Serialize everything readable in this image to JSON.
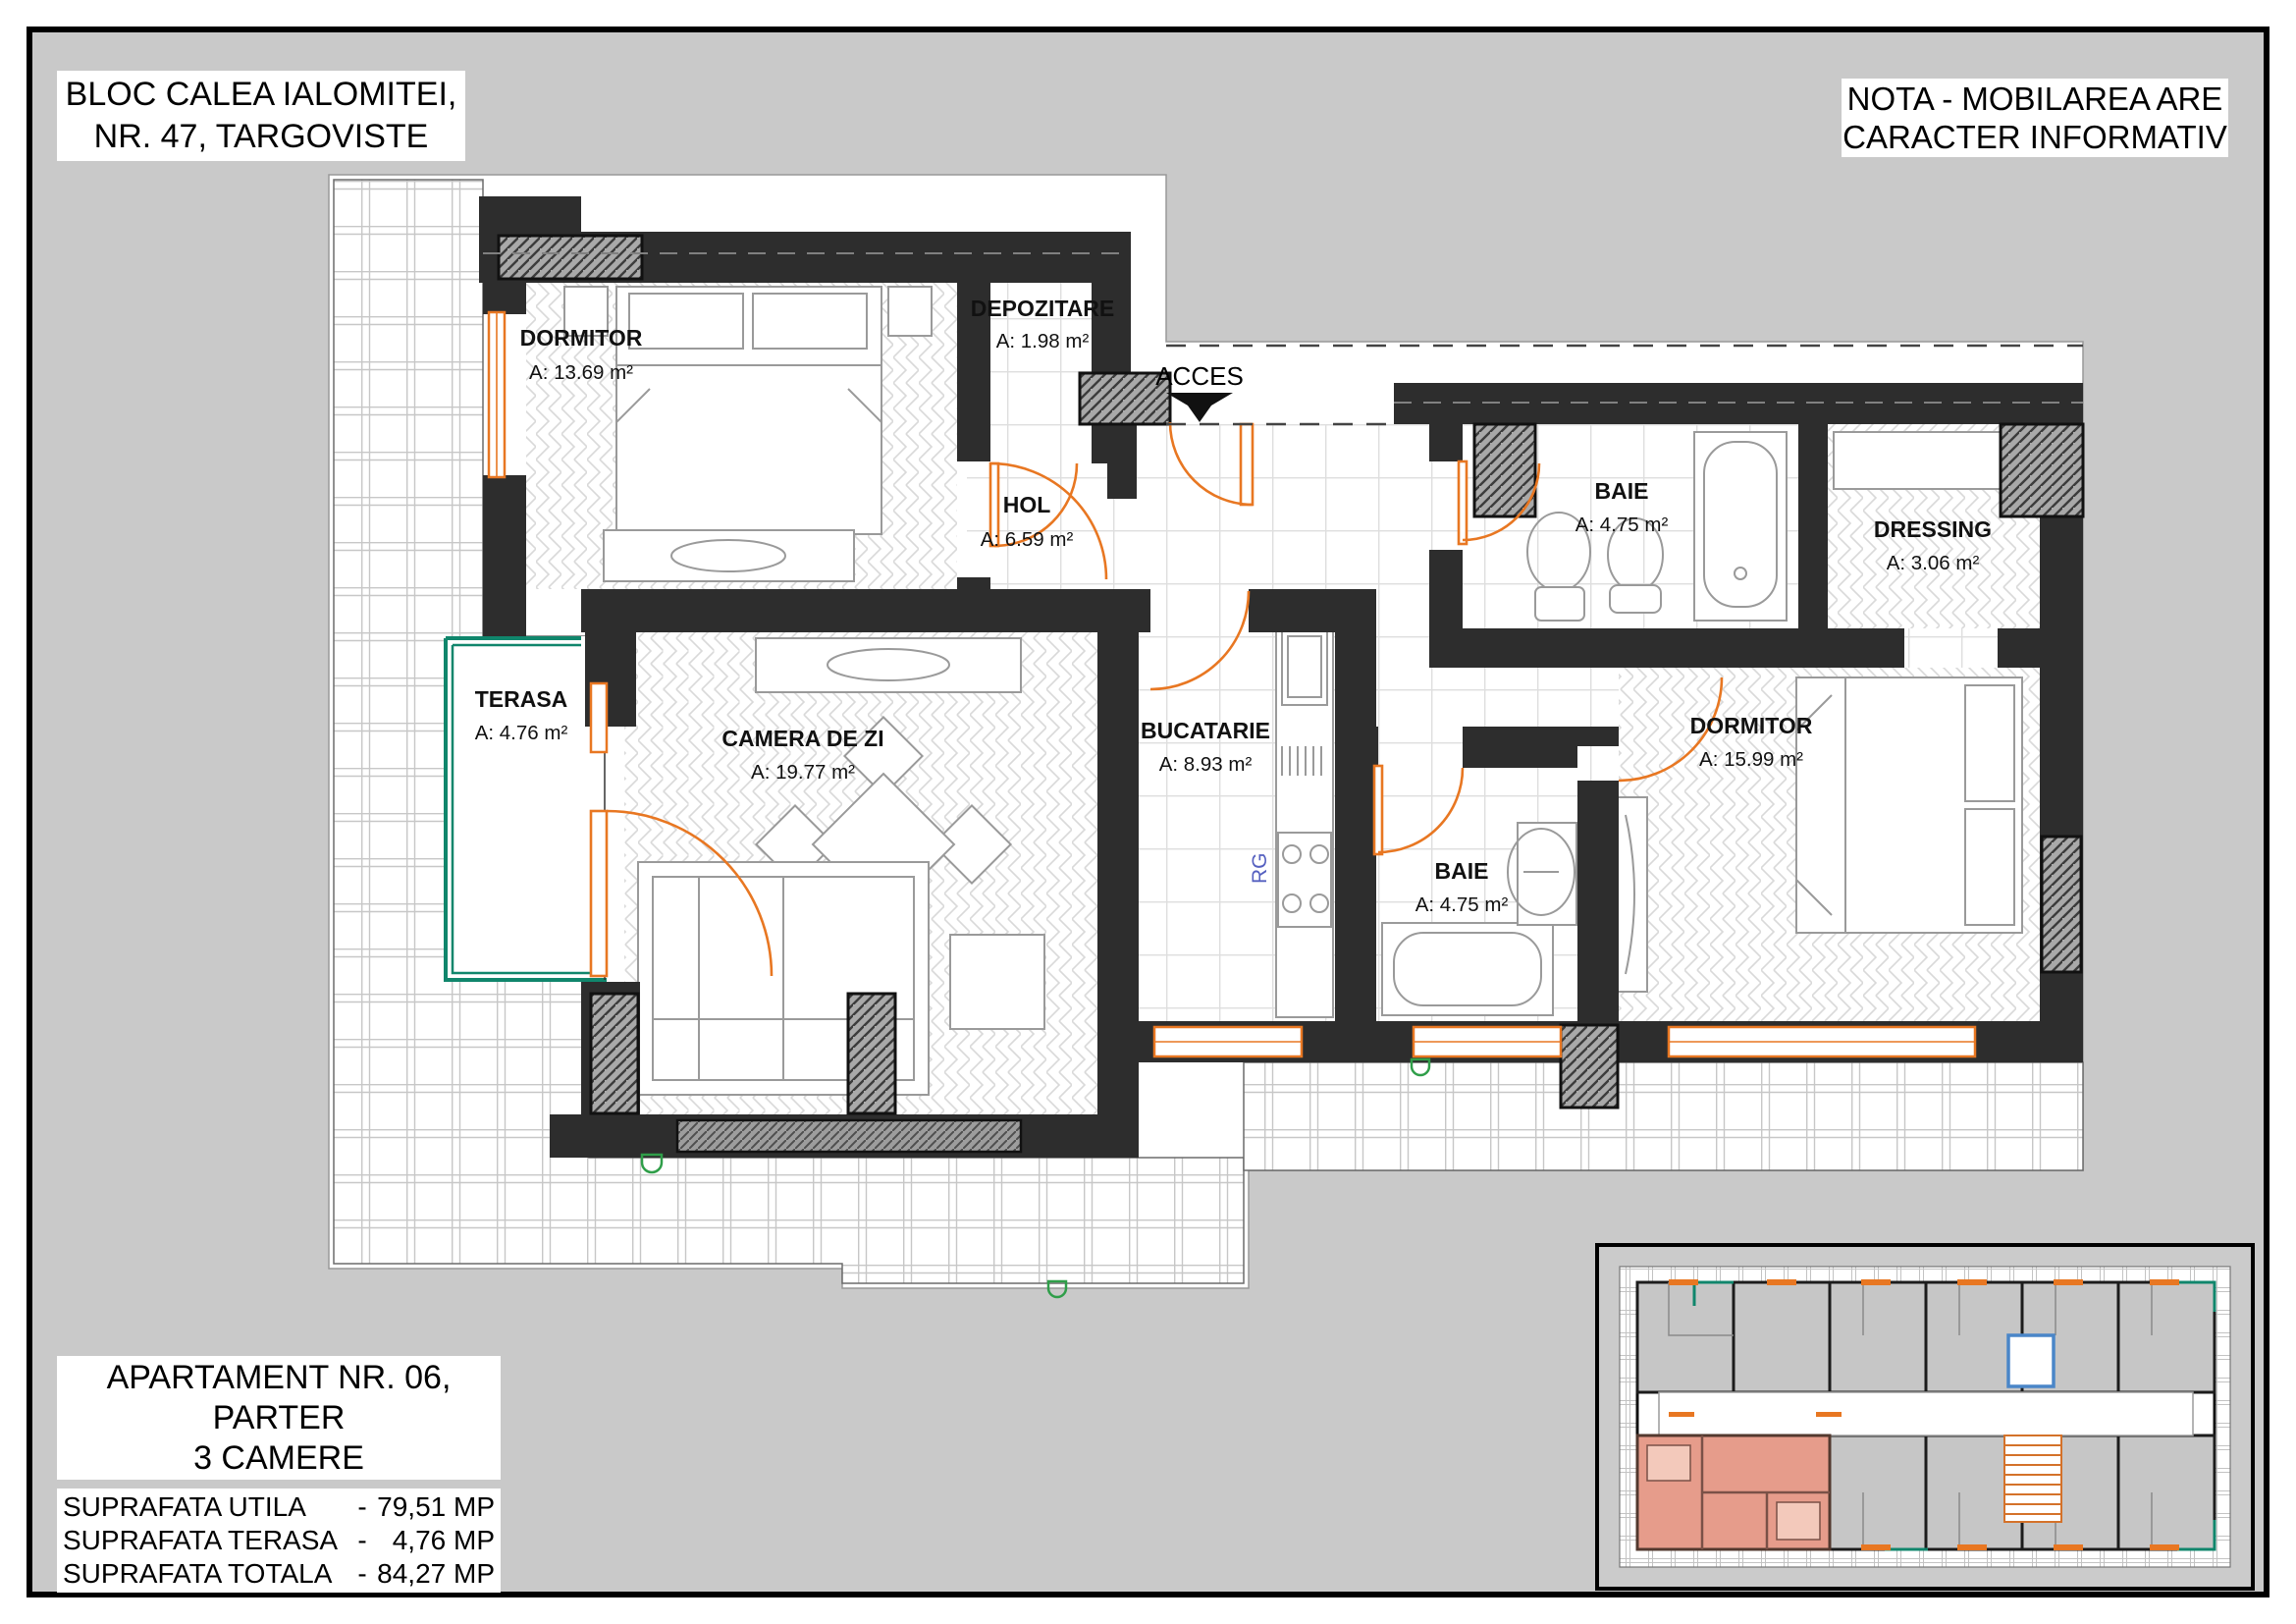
{
  "header": {
    "title_line1": "BLOC CALEA IALOMITEI,",
    "title_line2": "NR. 47, TARGOVISTE",
    "note_line1": "NOTA - MOBILAREA ARE",
    "note_line2": "CARACTER INFORMATIV"
  },
  "apartment": {
    "line1": "APARTAMENT NR. 06,",
    "line2": "PARTER",
    "line3": "3 CAMERE"
  },
  "areas": {
    "rows": [
      {
        "label": "SUPRAFATA UTILA",
        "dash": "-",
        "value": "79,51 MP"
      },
      {
        "label": "SUPRAFATA TERASA",
        "dash": "-",
        "value": "4,76 MP"
      },
      {
        "label": "SUPRAFATA TOTALA",
        "dash": "-",
        "value": "84,27 MP"
      }
    ]
  },
  "rooms": [
    {
      "name": "DORMITOR",
      "area": "A: 13.69 m²"
    },
    {
      "name": "DEPOZITARE",
      "area": "A: 1.98 m²"
    },
    {
      "name": "HOL",
      "area": "A: 6.59 m²"
    },
    {
      "name": "BAIE",
      "area": "A: 4.75 m²"
    },
    {
      "name": "DRESSING",
      "area": "A: 3.06 m²"
    },
    {
      "name": "TERASA",
      "area": "A: 4.76 m²"
    },
    {
      "name": "CAMERA DE ZI",
      "area": "A: 19.77 m²"
    },
    {
      "name": "BUCATARIE",
      "area": "A: 8.93 m²"
    },
    {
      "name": "BAIE",
      "area": "A: 4.75 m²"
    },
    {
      "name": "DORMITOR",
      "area": "A: 15.99 m²"
    }
  ],
  "plan": {
    "access_label": "ACCES",
    "stove_label": "RG"
  },
  "colors": {
    "page_gray": "#c9c9c9",
    "wall_dark": "#2d2d2d",
    "door_orange": "#e87722",
    "terrace_green": "#10866c",
    "highlight_salmon": "#e69c8b",
    "elevator_blue": "#4a86c8"
  }
}
